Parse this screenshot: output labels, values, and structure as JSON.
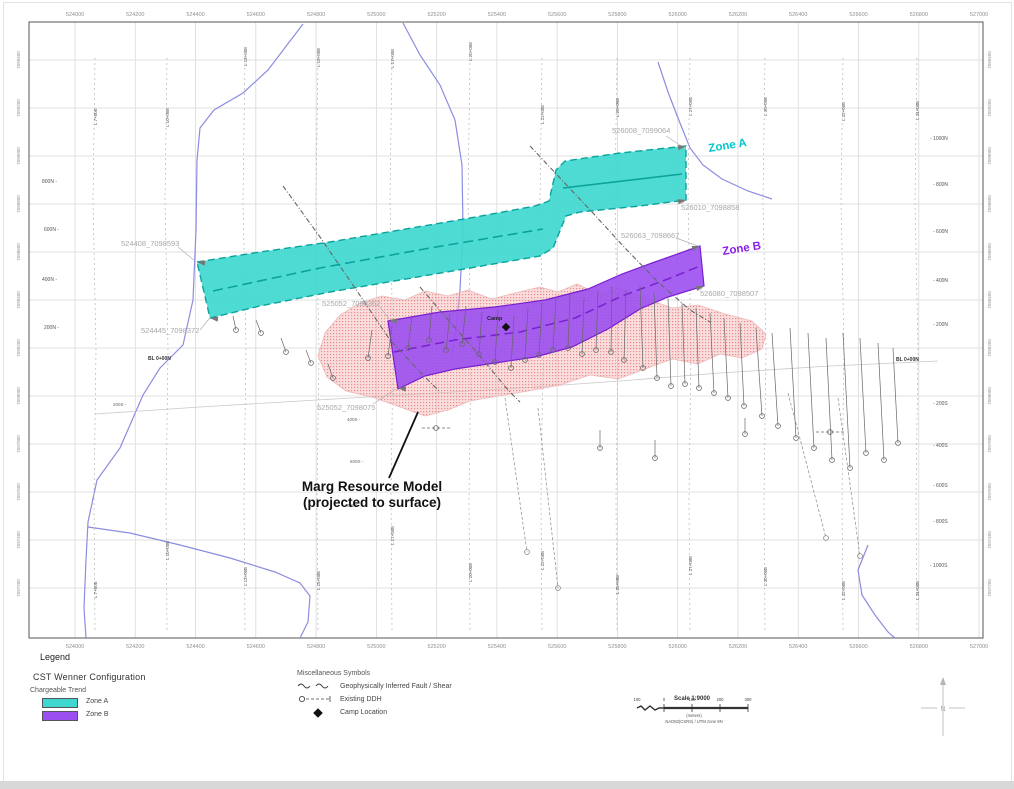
{
  "map": {
    "frame": {
      "x": 29,
      "y": 22,
      "w": 954,
      "h": 616
    },
    "easting": {
      "labels": [
        "524000",
        "524200",
        "524400",
        "524600",
        "524800",
        "525000",
        "525200",
        "525400",
        "525600",
        "525800",
        "526000",
        "526200",
        "526400",
        "526600",
        "526800",
        "527000"
      ],
      "x0": 75,
      "step": 60.27,
      "top_y": 16,
      "bottom_y": 648
    },
    "northing": {
      "labels": [
        "7099400",
        "7099200",
        "7099000",
        "7098800",
        "7098600",
        "7098400",
        "7098200",
        "7098000",
        "7097800",
        "7097600",
        "7097400",
        "7097200"
      ],
      "y0": 60,
      "step": 48,
      "left_x": 20,
      "right_x": 991
    },
    "survey_lines": [
      {
        "label": "L 7+00E",
        "x": 95,
        "ty": 125,
        "by": 598
      },
      {
        "label": "L 10+00E",
        "x": 167,
        "ty": 127,
        "by": 560
      },
      {
        "label": "L 13+00E",
        "x": 245,
        "ty": 66,
        "by": 586
      },
      {
        "label": "L 15+00E",
        "x": 318,
        "ty": 67,
        "by": 590
      },
      {
        "label": "L 17+00E",
        "x": 392,
        "ty": 68,
        "by": 545
      },
      {
        "label": "L 20+00E",
        "x": 470,
        "ty": 61,
        "by": 582
      },
      {
        "label": "L 22+00E",
        "x": 542,
        "ty": 124,
        "by": 570
      },
      {
        "label": "L 25+00E",
        "x": 617,
        "ty": 117,
        "by": 594
      },
      {
        "label": "L 27+00E",
        "x": 690,
        "ty": 116,
        "by": 575
      },
      {
        "label": "L 30+00E",
        "x": 765,
        "ty": 116,
        "by": 586
      },
      {
        "label": "L 32+00E",
        "x": 843,
        "ty": 121,
        "by": 600
      },
      {
        "label": "L 34+00E",
        "x": 917,
        "ty": 120,
        "by": 600
      }
    ],
    "stations_left": [
      {
        "t": "800N -",
        "x": 42,
        "y": 183
      },
      {
        "t": "600N -",
        "x": 44,
        "y": 231
      },
      {
        "t": "400N -",
        "x": 42,
        "y": 281
      },
      {
        "t": "200N -",
        "x": 44,
        "y": 329
      }
    ],
    "stations_right": [
      {
        "t": "- 1000N",
        "x": 930,
        "y": 140
      },
      {
        "t": "- 800N",
        "x": 933,
        "y": 186
      },
      {
        "t": "- 600N",
        "x": 933,
        "y": 233
      },
      {
        "t": "- 400N",
        "x": 933,
        "y": 282
      },
      {
        "t": "- 200N",
        "x": 933,
        "y": 326
      },
      {
        "t": "- 200S",
        "x": 933,
        "y": 405
      },
      {
        "t": "- 400S",
        "x": 933,
        "y": 447
      },
      {
        "t": "- 600S",
        "x": 933,
        "y": 487
      },
      {
        "t": "- 800S",
        "x": 933,
        "y": 523
      },
      {
        "t": "- 1000S",
        "x": 930,
        "y": 567
      }
    ],
    "stations_mid": [
      {
        "t": "200S -",
        "x": 113,
        "y": 406
      },
      {
        "t": "400S -",
        "x": 347,
        "y": 421
      },
      {
        "t": "600S -",
        "x": 350,
        "y": 463
      },
      {
        "t": "800S -",
        "x": 347,
        "y": 507
      }
    ],
    "baselines": [
      {
        "t": "BL 0+00N",
        "x": 148,
        "y": 360
      },
      {
        "t": "BL 0+00N",
        "x": 896,
        "y": 361
      }
    ],
    "streams": [
      [
        [
          303,
          24
        ],
        [
          268,
          70
        ],
        [
          243,
          93
        ],
        [
          214,
          110
        ],
        [
          200,
          128
        ],
        [
          197,
          160
        ],
        [
          196,
          230
        ],
        [
          193,
          300
        ],
        [
          183,
          345
        ],
        [
          160,
          368
        ],
        [
          143,
          395
        ],
        [
          120,
          448
        ],
        [
          97,
          480
        ],
        [
          88,
          522
        ],
        [
          86,
          560
        ],
        [
          84,
          608
        ],
        [
          86,
          638
        ]
      ],
      [
        [
          88,
          527
        ],
        [
          130,
          533
        ],
        [
          180,
          545
        ],
        [
          230,
          558
        ],
        [
          275,
          572
        ],
        [
          300,
          583
        ],
        [
          310,
          596
        ],
        [
          308,
          622
        ],
        [
          300,
          638
        ]
      ],
      [
        [
          403,
          23
        ],
        [
          420,
          55
        ],
        [
          440,
          85
        ],
        [
          455,
          120
        ],
        [
          462,
          165
        ],
        [
          463,
          230
        ],
        [
          460,
          290
        ],
        [
          456,
          330
        ],
        [
          451,
          358
        ]
      ],
      [
        [
          658,
          62
        ],
        [
          668,
          92
        ],
        [
          678,
          118
        ],
        [
          690,
          148
        ],
        [
          703,
          165
        ],
        [
          722,
          179
        ],
        [
          748,
          191
        ],
        [
          772,
          199
        ]
      ],
      [
        [
          868,
          545
        ],
        [
          858,
          570
        ],
        [
          862,
          595
        ],
        [
          875,
          615
        ],
        [
          888,
          632
        ],
        [
          895,
          638
        ]
      ]
    ],
    "trail": [
      [
        95,
        414
      ],
      [
        200,
        407
      ],
      [
        300,
        401
      ],
      [
        420,
        394
      ],
      [
        520,
        388
      ],
      [
        620,
        381
      ],
      [
        720,
        373
      ],
      [
        830,
        366
      ],
      [
        938,
        361
      ]
    ],
    "faults": [
      [
        [
          283,
          186
        ],
        [
          320,
          237
        ],
        [
          355,
          288
        ],
        [
          390,
          340
        ],
        [
          420,
          372
        ],
        [
          440,
          392
        ]
      ],
      [
        [
          530,
          146
        ],
        [
          560,
          178
        ],
        [
          592,
          212
        ],
        [
          625,
          248
        ],
        [
          658,
          282
        ],
        [
          690,
          310
        ],
        [
          710,
          322
        ]
      ],
      [
        [
          420,
          287
        ],
        [
          450,
          322
        ],
        [
          480,
          356
        ],
        [
          508,
          390
        ],
        [
          520,
          402
        ]
      ]
    ],
    "pink_area": [
      [
        318,
        356
      ],
      [
        325,
        333
      ],
      [
        340,
        315
      ],
      [
        360,
        303
      ],
      [
        382,
        296
      ],
      [
        405,
        300
      ],
      [
        425,
        291
      ],
      [
        448,
        296
      ],
      [
        468,
        290
      ],
      [
        492,
        299
      ],
      [
        515,
        293
      ],
      [
        540,
        287
      ],
      [
        558,
        292
      ],
      [
        577,
        284
      ],
      [
        598,
        294
      ],
      [
        618,
        288
      ],
      [
        645,
        298
      ],
      [
        672,
        308
      ],
      [
        698,
        305
      ],
      [
        725,
        314
      ],
      [
        752,
        321
      ],
      [
        766,
        334
      ],
      [
        762,
        349
      ],
      [
        742,
        358
      ],
      [
        720,
        354
      ],
      [
        698,
        364
      ],
      [
        672,
        359
      ],
      [
        645,
        369
      ],
      [
        618,
        379
      ],
      [
        590,
        375
      ],
      [
        560,
        385
      ],
      [
        528,
        391
      ],
      [
        498,
        396
      ],
      [
        470,
        401
      ],
      [
        448,
        410
      ],
      [
        425,
        416
      ],
      [
        400,
        407
      ],
      [
        372,
        397
      ],
      [
        346,
        391
      ],
      [
        327,
        377
      ]
    ],
    "zone_a": {
      "label": "Zone A",
      "label_x": 709,
      "label_y": 152,
      "poly": [
        [
          197,
          262
        ],
        [
          260,
          252
        ],
        [
          330,
          242
        ],
        [
          400,
          230
        ],
        [
          470,
          218
        ],
        [
          535,
          206
        ],
        [
          549,
          201
        ],
        [
          556,
          170
        ],
        [
          565,
          161
        ],
        [
          620,
          153
        ],
        [
          686,
          146
        ],
        [
          686,
          200
        ],
        [
          640,
          206
        ],
        [
          580,
          212
        ],
        [
          566,
          216
        ],
        [
          553,
          248
        ],
        [
          540,
          256
        ],
        [
          470,
          268
        ],
        [
          400,
          280
        ],
        [
          330,
          292
        ],
        [
          260,
          306
        ],
        [
          210,
          318
        ]
      ],
      "center_dashed": [
        [
          213,
          291
        ],
        [
          320,
          268
        ],
        [
          430,
          248
        ],
        [
          543,
          229
        ]
      ],
      "center_solid": [
        [
          563,
          188
        ],
        [
          682,
          174
        ]
      ]
    },
    "zone_b": {
      "label": "Zone B",
      "label_x": 723,
      "label_y": 255,
      "poly": [
        [
          388,
          321
        ],
        [
          440,
          312
        ],
        [
          495,
          307
        ],
        [
          545,
          300
        ],
        [
          588,
          289
        ],
        [
          622,
          274
        ],
        [
          652,
          263
        ],
        [
          700,
          246
        ],
        [
          704,
          286
        ],
        [
          668,
          297
        ],
        [
          640,
          309
        ],
        [
          608,
          329
        ],
        [
          572,
          347
        ],
        [
          535,
          357
        ],
        [
          495,
          363
        ],
        [
          455,
          369
        ],
        [
          425,
          376
        ],
        [
          398,
          389
        ]
      ],
      "center": [
        [
          394,
          352
        ],
        [
          455,
          340
        ],
        [
          520,
          332
        ],
        [
          575,
          318
        ],
        [
          622,
          296
        ],
        [
          668,
          279
        ],
        [
          700,
          266
        ]
      ]
    },
    "tips": [
      {
        "x": 686,
        "y": 146,
        "a": -12
      },
      {
        "x": 686,
        "y": 200,
        "a": -12
      },
      {
        "x": 700,
        "y": 246,
        "a": -18
      },
      {
        "x": 704,
        "y": 286,
        "a": -18
      },
      {
        "x": 197,
        "y": 262,
        "a": 188
      },
      {
        "x": 210,
        "y": 318,
        "a": 188
      },
      {
        "x": 389,
        "y": 320,
        "a": 188
      },
      {
        "x": 398,
        "y": 388,
        "a": 188
      }
    ],
    "coord_labels": [
      {
        "t": "526008_7099064",
        "x": 612,
        "y": 133
      },
      {
        "t": "526010_7098858",
        "x": 681,
        "y": 210
      },
      {
        "t": "526063_7098667",
        "x": 621,
        "y": 238
      },
      {
        "t": "526080_7098507",
        "x": 700,
        "y": 296
      },
      {
        "t": "524408_7098593",
        "x": 121,
        "y": 246
      },
      {
        "t": "524445_7098372",
        "x": 141,
        "y": 333
      },
      {
        "t": "525052_7098362",
        "x": 322,
        "y": 306
      },
      {
        "t": "525052_7098075",
        "x": 317,
        "y": 410
      }
    ],
    "leaders": [
      [
        178,
        247,
        195,
        261
      ],
      [
        200,
        330,
        209,
        319
      ],
      [
        666,
        136,
        683,
        147
      ],
      [
        681,
        204,
        686,
        200
      ],
      [
        676,
        238,
        698,
        246
      ],
      [
        700,
        290,
        703,
        287
      ],
      [
        380,
        307,
        389,
        319
      ],
      [
        373,
        404,
        396,
        389
      ]
    ],
    "drills": [
      [
        233,
        316,
        236,
        330
      ],
      [
        256,
        320,
        261,
        333
      ],
      [
        281,
        338,
        286,
        352
      ],
      [
        306,
        350,
        311,
        363
      ],
      [
        328,
        364,
        333,
        378
      ],
      [
        372,
        330,
        368,
        358
      ],
      [
        392,
        326,
        388,
        356
      ],
      [
        412,
        316,
        408,
        348
      ],
      [
        432,
        306,
        429,
        340
      ],
      [
        450,
        314,
        446,
        350
      ],
      [
        466,
        306,
        462,
        344
      ],
      [
        482,
        312,
        479,
        354
      ],
      [
        498,
        310,
        495,
        362
      ],
      [
        514,
        316,
        511,
        368
      ],
      [
        528,
        308,
        525,
        360
      ],
      [
        542,
        303,
        539,
        355
      ],
      [
        556,
        298,
        553,
        350
      ],
      [
        570,
        294,
        568,
        348
      ],
      [
        584,
        298,
        582,
        354
      ],
      [
        598,
        290,
        596,
        350
      ],
      [
        612,
        286,
        611,
        352
      ],
      [
        626,
        290,
        624,
        360
      ],
      [
        640,
        286,
        643,
        368
      ],
      [
        654,
        293,
        657,
        378
      ],
      [
        668,
        298,
        671,
        386
      ],
      [
        682,
        303,
        685,
        384
      ],
      [
        696,
        308,
        699,
        388
      ],
      [
        710,
        313,
        714,
        393
      ],
      [
        724,
        318,
        728,
        398
      ],
      [
        740,
        323,
        744,
        406
      ],
      [
        756,
        328,
        762,
        416
      ],
      [
        772,
        333,
        778,
        426
      ],
      [
        790,
        328,
        796,
        438
      ],
      [
        808,
        333,
        814,
        448
      ],
      [
        826,
        338,
        832,
        460
      ],
      [
        843,
        333,
        850,
        468
      ],
      [
        860,
        338,
        866,
        453
      ],
      [
        878,
        343,
        884,
        460
      ],
      [
        893,
        348,
        898,
        443
      ],
      [
        600,
        430,
        600,
        448
      ],
      [
        655,
        440,
        655,
        458
      ],
      [
        745,
        418,
        745,
        434
      ]
    ],
    "long_drills": [
      [
        505,
        398,
        527,
        552
      ],
      [
        538,
        408,
        558,
        588
      ],
      [
        788,
        393,
        826,
        538
      ],
      [
        838,
        398,
        860,
        556
      ]
    ],
    "drill_symbols": [
      [
        436,
        428
      ],
      [
        830,
        432
      ]
    ],
    "camp": {
      "x": 506,
      "y": 327,
      "label": "Camp",
      "lx": 487,
      "ly": 320
    },
    "marg": {
      "line1": "Marg Resource Model",
      "line2": "(projected to surface)",
      "x": 372,
      "y1": 491,
      "y2": 507,
      "leader": [
        418,
        412,
        389,
        478
      ]
    }
  },
  "colors": {
    "zone_a": "#3fd8d0",
    "zone_a_edge": "#0aa39b",
    "zone_a_text": "#00c6ce",
    "zone_b": "#9b4ff0",
    "zone_b_edge": "#7a1fd0",
    "zone_b_text": "#8a1fe8",
    "pink": "#f4b4b4",
    "pink_dot": "#e87e7e",
    "stream": "#8c8ce0",
    "grid": "#d9d9d9",
    "frame": "#555555",
    "axis_text": "#909090",
    "coord_text": "#a8a8a8",
    "fault": "#666666",
    "drill": "#666666"
  },
  "legend": {
    "title": "Legend",
    "cst_title": "CST Wenner Configuration",
    "chargeable_trend": "Chargeable Trend",
    "zone_a": "Zone A",
    "zone_b": "Zone B",
    "misc_title": "Miscellaneous Symbols",
    "fault": "Geophysically Inferred Fault / Shear",
    "ddh": "Existing DDH",
    "camp": "Camp Location"
  },
  "scalebar": {
    "title": "Scale 1:9000",
    "ticks": [
      "100",
      "0",
      "100",
      "200",
      "300"
    ],
    "meters": "(meters)",
    "datum": "NAD83(CSRS) / UTM zone 8N"
  },
  "north_label": "N"
}
